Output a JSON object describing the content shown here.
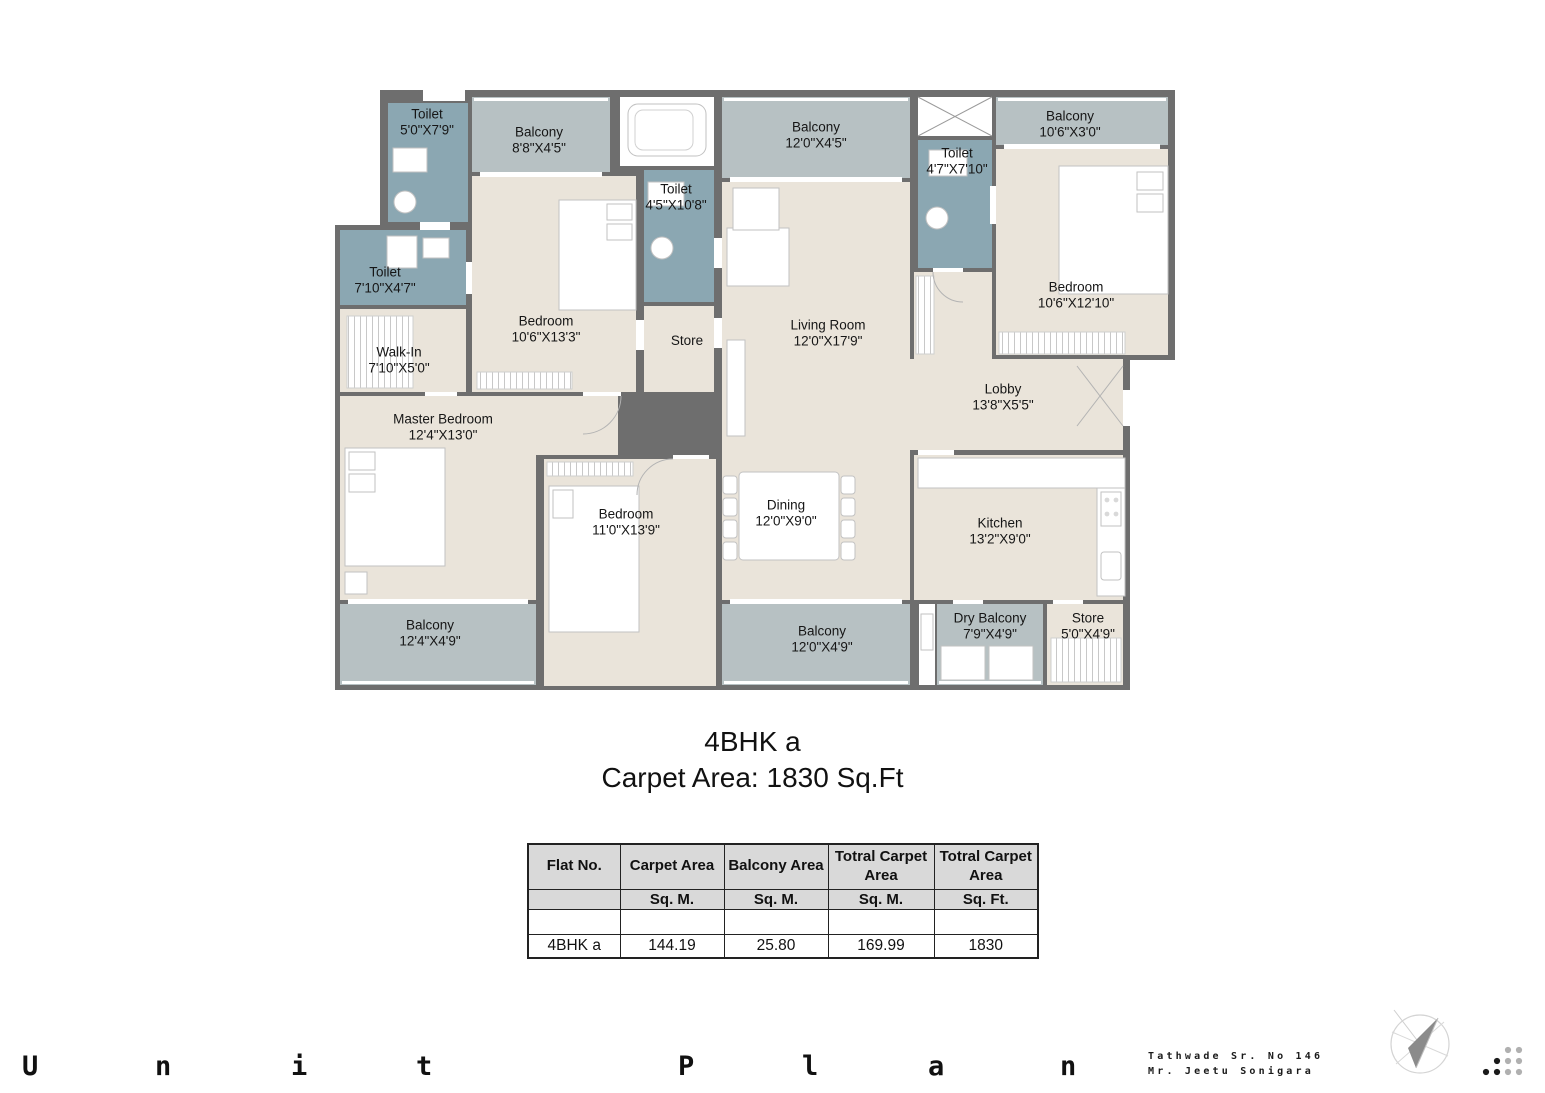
{
  "title": {
    "name": "4BHK a",
    "carpet": "Carpet Area: 1830 Sq.Ft"
  },
  "plan": {
    "rooms": [
      {
        "name": "Toilet",
        "dims": "5'0\"X7'9\""
      },
      {
        "name": "Balcony",
        "dims": "8'8\"X4'5\""
      },
      {
        "name": "Toilet",
        "dims": "4'5\"X10'8\""
      },
      {
        "name": "Balcony",
        "dims": "12'0\"X4'5\""
      },
      {
        "name": "Toilet",
        "dims": "4'7\"X7'10\""
      },
      {
        "name": "Balcony",
        "dims": "10'6\"X3'0\""
      },
      {
        "name": "Bedroom",
        "dims": "10'6\"X12'10\""
      },
      {
        "name": "Toilet",
        "dims": "7'10\"X4'7\""
      },
      {
        "name": "Walk-In",
        "dims": "7'10\"X5'0\""
      },
      {
        "name": "Bedroom",
        "dims": "10'6\"X13'3\""
      },
      {
        "name": "Store",
        "dims": ""
      },
      {
        "name": "Living Room",
        "dims": "12'0\"X17'9\""
      },
      {
        "name": "Lobby",
        "dims": "13'8\"X5'5\""
      },
      {
        "name": "Master Bedroom",
        "dims": "12'4\"X13'0\""
      },
      {
        "name": "Bedroom",
        "dims": "11'0\"X13'9\""
      },
      {
        "name": "Dining",
        "dims": "12'0\"X9'0\""
      },
      {
        "name": "Kitchen",
        "dims": "13'2\"X9'0\""
      },
      {
        "name": "Balcony",
        "dims": "12'4\"X4'9\""
      },
      {
        "name": "Balcony",
        "dims": "12'0\"X4'9\""
      },
      {
        "name": "Dry Balcony",
        "dims": "7'9\"X4'9\""
      },
      {
        "name": "Store",
        "dims": "5'0\"X4'9\""
      }
    ]
  },
  "table": {
    "headers": [
      "Flat No.",
      "Carpet Area",
      "Balcony Area",
      "Totral Carpet Area",
      "Totral Carpet Area"
    ],
    "units": [
      "",
      "Sq. M.",
      "Sq. M.",
      "Sq. M.",
      "Sq. Ft."
    ],
    "row": [
      "4BHK a",
      "144.19",
      "25.80",
      "169.99",
      "1830"
    ]
  },
  "footer": {
    "letters": [
      "U",
      "n",
      "i",
      "t",
      "P",
      "l",
      "a",
      "n"
    ],
    "site_line1": "Tathwade Sr. No 146",
    "site_line2": "Mr. Jeetu Sonigara"
  },
  "icons": {
    "compass": "compass-north-icon",
    "dots": "dots-grid-logo"
  },
  "colors": {
    "wall": "#6e6e6e",
    "floor": "#eae4da",
    "balcony": "#b7c1c3",
    "toilet": "#8ba7b2",
    "table_header_bg": "#d9d9d9",
    "text": "#161616"
  }
}
